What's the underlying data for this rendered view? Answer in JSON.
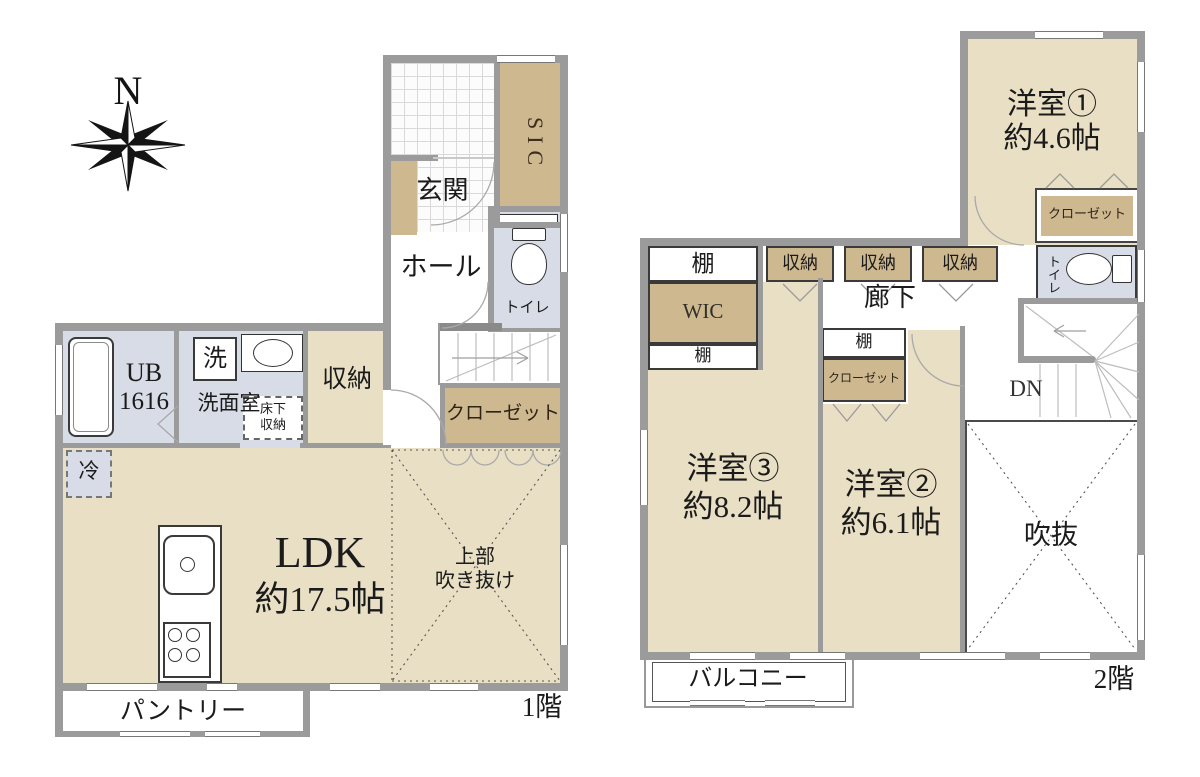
{
  "compass": {
    "north": "N"
  },
  "palette": {
    "room_beige": "#e9dfc4",
    "closet_beige": "#cdb890",
    "wet_area_blue": "#d7dce6",
    "wall_gray": "#9b9b9b",
    "tile_white": "#fcfcfc"
  },
  "floor1": {
    "floor_label": "1階",
    "entrance": "玄関",
    "sic": "SIC",
    "hall": "ホール",
    "toilet": "トイレ",
    "bath_line1": "UB",
    "bath_line2": "1616",
    "washer": "洗",
    "washroom": "洗面室",
    "underfloor_line1": "床下",
    "underfloor_line2": "収納",
    "storage": "収納",
    "closet": "クローゼット",
    "fridge": "冷",
    "ldk_line1": "LDK",
    "ldk_line2": "約17.5帖",
    "void_line1": "上部",
    "void_line2": "吹き抜け",
    "pantry": "パントリー"
  },
  "floor2": {
    "floor_label": "2階",
    "room1_line1": "洋室①",
    "room1_line2": "約4.6帖",
    "room1_closet": "クローゼット",
    "shelf_top": "棚",
    "wic": "WIC",
    "shelf_bottom": "棚",
    "storage_a": "収納",
    "storage_b": "収納",
    "storage_c": "収納",
    "hallway": "廊下",
    "toilet": "トイレ",
    "down": "DN",
    "shelf_room2": "棚",
    "room2_closet": "クローゼット",
    "room3_line1": "洋室③",
    "room3_line2": "約8.2帖",
    "room2_line1": "洋室②",
    "room2_line2": "約6.1帖",
    "void": "吹抜",
    "balcony": "バルコニー"
  }
}
